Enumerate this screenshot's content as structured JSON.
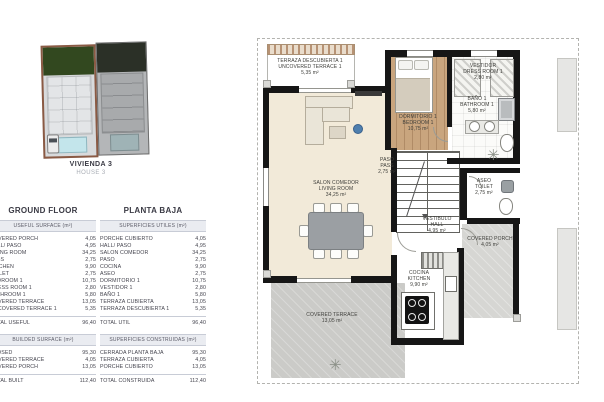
{
  "thumbnail": {
    "caption_line1": "VIVIENDA 3",
    "caption_line2": "HOUSE 3"
  },
  "tables": {
    "ground_floor": {
      "title": "GROUND FLOOR",
      "useful_header": "USEFUL SURFACE (m²)",
      "useful_rows": [
        {
          "label": "COVERED PORCH",
          "value": "4,05"
        },
        {
          "label": "HALL/ PASO",
          "value": "4,95"
        },
        {
          "label": "LIVING ROOM",
          "value": "34,25"
        },
        {
          "label": "PASS",
          "value": "2,75"
        },
        {
          "label": "KITCHEN",
          "value": "9,90"
        },
        {
          "label": "TOILET",
          "value": "2,75"
        },
        {
          "label": "BEDROOM 1",
          "value": "10,75"
        },
        {
          "label": "DRESS ROOM 1",
          "value": "2,80"
        },
        {
          "label": "BATHROOM 1",
          "value": "5,80"
        },
        {
          "label": "COVERED TERRACE",
          "value": "13,05"
        },
        {
          "label": "UNCOVERED TERRACE 1",
          "value": "5,35"
        }
      ],
      "useful_total": {
        "label": "TOTAL USEFUL",
        "value": "96,40"
      },
      "built_header": "BUILDED SURFACE (m²)",
      "built_rows": [
        {
          "label": "CLOSED",
          "value": "95,30"
        },
        {
          "label": "COVERED TERRACE",
          "value": "4,05"
        },
        {
          "label": "COVERED PORCH",
          "value": "13,05"
        }
      ],
      "built_total": {
        "label": "TOTAL BUILT",
        "value": "112,40"
      }
    },
    "planta_baja": {
      "title": "PLANTA BAJA",
      "useful_header": "SUPERFICIES UTILES (m²)",
      "useful_rows": [
        {
          "label": "PORCHE CUBIERTO",
          "value": "4,05"
        },
        {
          "label": "HALL/ PASO",
          "value": "4,95"
        },
        {
          "label": "SALON COMEDOR",
          "value": "34,25"
        },
        {
          "label": "PASO",
          "value": "2,75"
        },
        {
          "label": "COCINA",
          "value": "9,90"
        },
        {
          "label": "ASEO",
          "value": "2,75"
        },
        {
          "label": "DORMITORIO 1",
          "value": "10,75"
        },
        {
          "label": "VESTIDOR 1",
          "value": "2,80"
        },
        {
          "label": "BAÑO 1",
          "value": "5,80"
        },
        {
          "label": "TERRAZA CUBIERTA",
          "value": "13,05"
        },
        {
          "label": "TERRAZA DESCUBIERTA 1",
          "value": "5,35"
        }
      ],
      "useful_total": {
        "label": "TOTAL UTIL",
        "value": "96,40"
      },
      "built_header": "SUPERFICIES CONSTRUIDAS (m²)",
      "built_rows": [
        {
          "label": "CERRADA PLANTA BAJA",
          "value": "95,30"
        },
        {
          "label": "TERRAZA CUBIERTA",
          "value": "4,05"
        },
        {
          "label": "PORCHE CUBIERTO",
          "value": "13,05"
        }
      ],
      "built_total": {
        "label": "TOTAL CONSTRUIDA",
        "value": "112,40"
      }
    }
  },
  "plan": {
    "rooms": [
      {
        "es": "TERRAZA DESCUBIERTA 1",
        "en": "UNCOVERED TERRACE 1",
        "area": "5,35 m²"
      },
      {
        "es": "DORMITORIO 1",
        "en": "BEDROOM 1",
        "area": "10,75 m²"
      },
      {
        "es": "VESTIDOR",
        "en": "DRESS ROOM 1",
        "area": "2,80 m²"
      },
      {
        "es": "BAÑO 1",
        "en": "BATHROOM 1",
        "area": "5,80 m²"
      },
      {
        "es": "PASO",
        "en": "PASS",
        "area": "2,75 m²"
      },
      {
        "es": "SALON COMEDOR",
        "en": "LIVING ROOM",
        "area": "34,25 m²"
      },
      {
        "es": "ASEO",
        "en": "TOILET",
        "area": "2,75 m²"
      },
      {
        "es": "VESTIBULO",
        "en": "HALL",
        "area": "4,95 m²"
      },
      {
        "en": "COVERED PORCH",
        "area": "4,05 m²"
      },
      {
        "es": "COCINA",
        "en": "KITCHEN",
        "area": "9,90 m²"
      },
      {
        "en": "COVERED TERRACE",
        "area": "13,05 m²"
      }
    ]
  },
  "colors": {
    "wall": "#161616",
    "living_floor": "#f2ead9",
    "bedroom_wood": "#c9a57e",
    "terrace_concrete": "#cbcbc8",
    "porch_concrete": "#d6d6d3",
    "highlight_plot_border": "#8a5a44",
    "table_band_bg": "#eaecf1"
  }
}
